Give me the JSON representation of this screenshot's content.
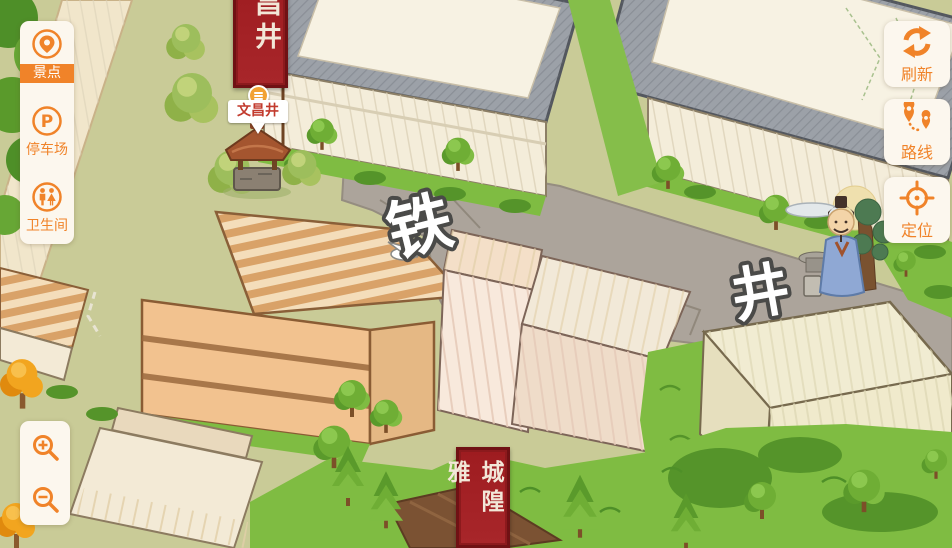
{
  "accent_color": "#F08329",
  "sidebar": {
    "items": [
      {
        "label": "景点",
        "icon": "scenic-spot-icon",
        "active": true
      },
      {
        "label": "停车场",
        "icon": "parking-icon",
        "active": false
      },
      {
        "label": "卫生间",
        "icon": "restroom-icon",
        "active": false
      }
    ]
  },
  "zoom_controls": {
    "icons": [
      "zoom-in-icon",
      "zoom-out-icon"
    ]
  },
  "tools": [
    {
      "label": "刷新",
      "icon": "refresh-icon"
    },
    {
      "label": "路线",
      "icon": "route-icon"
    },
    {
      "label": "定位",
      "icon": "locate-icon"
    }
  ],
  "map": {
    "street_label_chars": [
      "铁",
      "井"
    ],
    "poi": {
      "label": "文昌井"
    },
    "top_banner_text": "昌井",
    "bottom_banner_text": "城隍雅",
    "colors": {
      "ground": "#C9CB97",
      "grass": "#7FBC42",
      "stone_road": "#ACA49B",
      "roof_gray": "#9CA1A8",
      "banner_red": "#A32125",
      "poi_text_red": "#C23B2E"
    }
  }
}
